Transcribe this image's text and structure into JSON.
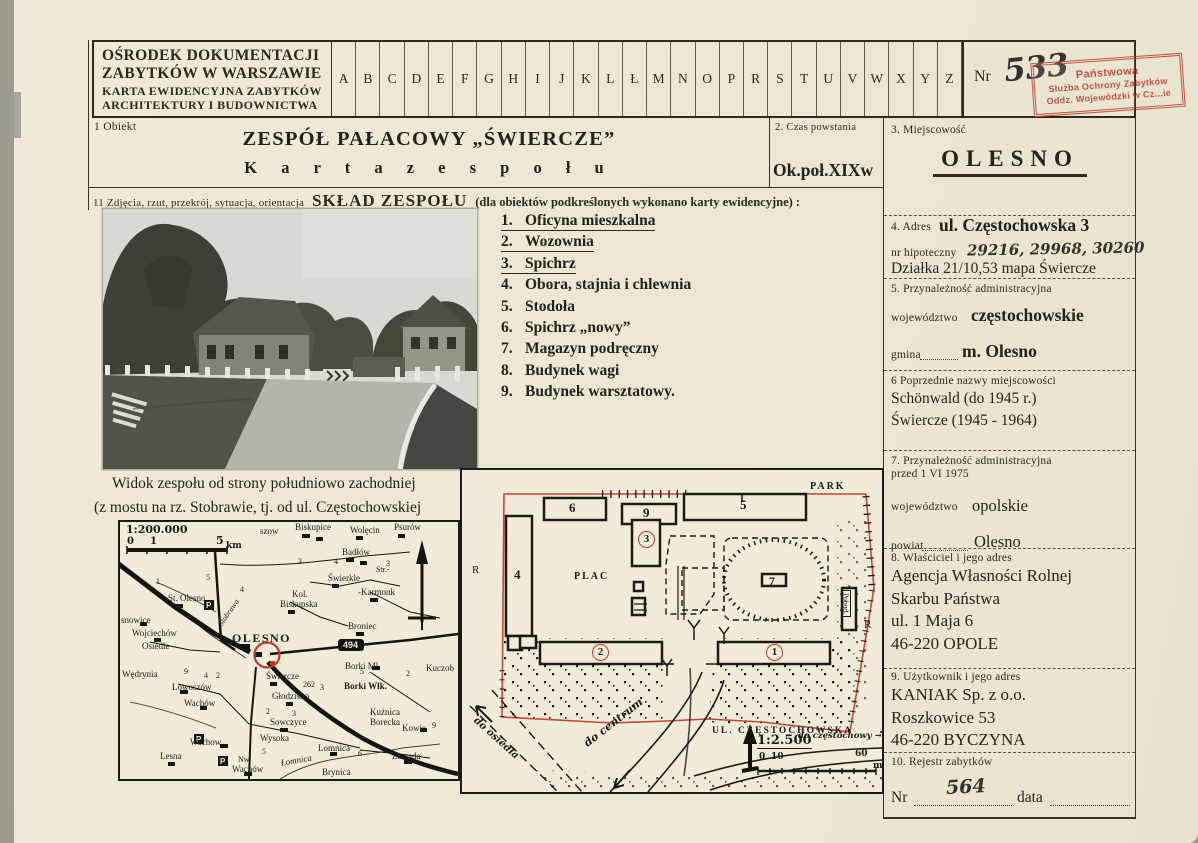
{
  "card": {
    "institution_lines": [
      {
        "t": "OŚRODEK DOKUMENTACJI",
        "fs": 15.5
      },
      {
        "t": "ZABYTKÓW W WARSZAWIE",
        "fs": 15.5
      },
      {
        "t": "KARTA EWIDENCYJNA ZABYTKÓW",
        "fs": 12
      },
      {
        "t": "ARCHITEKTURY I BUDOWNICTWA",
        "fs": 12
      }
    ],
    "index_letters": [
      "A",
      "B",
      "C",
      "D",
      "E",
      "F",
      "G",
      "H",
      "I",
      "J",
      "K",
      "L",
      "Ł",
      "M",
      "N",
      "O",
      "P",
      "R",
      "S",
      "T",
      "U",
      "V",
      "W",
      "X",
      "Y",
      "Z"
    ],
    "nr_label": "Nr",
    "nr_value": "533",
    "stamp_lines": [
      {
        "t": "Państwowa",
        "fs": 11
      },
      {
        "t": "Służba Ochrony Zabytków",
        "fs": 9
      },
      {
        "t": "Oddz. Wojewódzki w Cz...ie",
        "fs": 9
      }
    ],
    "stamp_color": "#c04638"
  },
  "field1": {
    "label": "1  Obiekt",
    "title": "ZESPÓŁ PAŁACOWY „ŚWIERCZE”",
    "subtitle": "K a r t a   z e s p o ł u"
  },
  "field2": {
    "label": "2. Czas powstania",
    "value": "Ok.poł.XIXw"
  },
  "field3": {
    "label": "3.   Miejscowość",
    "value": "OLESNO"
  },
  "field4": {
    "label": "4. Adres",
    "value": "ul. Częstochowska 3",
    "hipoteczny_label": "nr hipoteczny",
    "hipoteczny_value": "29216, 29968, 30260",
    "dzialka": "Działka 21/10,53 mapa Świercze"
  },
  "field5": {
    "label": "5.   Przynależność administracyjna",
    "woj_label": "województwo",
    "woj": "częstochowskie",
    "gmina_label": "gmina",
    "gmina": "m. Olesno"
  },
  "field6": {
    "label": "6  Poprzednie nazwy miejscowości",
    "lines": [
      "Schönwald (do 1945 r.)",
      "Świercze (1945 - 1964)"
    ]
  },
  "field7": {
    "label": "7. Przynależność administracyjna",
    "label2": "przed 1 VI 1975",
    "woj_label": "województwo",
    "woj": "opolskie",
    "powiat_label": "powiat",
    "powiat": "Olesno"
  },
  "field8": {
    "label": "8. Właściciel i jego adres",
    "lines": [
      "Agencja Własności Rolnej",
      "Skarbu Państwa",
      "ul. 1 Maja 6",
      "46-220 OPOLE"
    ]
  },
  "field9": {
    "label": "9. Użytkownik i jego adres",
    "lines": [
      "KANIAK Sp. z o.o.",
      "Roszkowice 53",
      "46-220 BYCZYNA"
    ]
  },
  "field10": {
    "label": "10. Rejestr zabytków",
    "nr_label": "Nr",
    "nr_value": "564",
    "data_label": "data"
  },
  "field11": {
    "label": "11  Zdjęcia, rzut, przekrój, sytuacja, orientacja",
    "heading": "SKŁAD ZESPOŁU",
    "note": "(dla obiektów podkreślonych wykonano karty ewidencyjne) :"
  },
  "composition": [
    {
      "num": "1.",
      "name": "Oficyna mieszkalna",
      "u": true
    },
    {
      "num": "2.",
      "name": "Wozownia",
      "u": true
    },
    {
      "num": "3.",
      "name": "Spichrz",
      "u": true
    },
    {
      "num": "4.",
      "name": "Obora, stajnia i chlewnia"
    },
    {
      "num": "5.",
      "name": "Stodoła"
    },
    {
      "num": "6.",
      "name": "Spichrz „nowy”"
    },
    {
      "num": "7.",
      "name": "Magazyn podręczny"
    },
    {
      "num": "8.",
      "name": "Budynek wagi"
    },
    {
      "num": "9.",
      "name": "Budynek warsztatowy."
    }
  ],
  "photo_caption": [
    {
      "t": "Widok zespołu od strony południowo zachodniej",
      "c": "ind"
    },
    {
      "t": "(z mostu na rz. Stobrawie, tj. od ul. Częstochowskiej"
    }
  ],
  "map": {
    "scale": "1:200.000",
    "road_number": "494",
    "labels": [
      {
        "t": "1:200.000",
        "x": 6,
        "y": 2,
        "c": "h b",
        "fs": 11
      },
      {
        "t": "0",
        "x": 7,
        "y": 15,
        "c": "h",
        "fs": 10
      },
      {
        "t": "1",
        "x": 30,
        "y": 15,
        "c": "h",
        "fs": 10
      },
      {
        "t": "5",
        "x": 96,
        "y": 13,
        "c": "h",
        "fs": 11
      },
      {
        "t": "km",
        "x": 106,
        "y": 20,
        "c": "h",
        "fs": 9
      },
      {
        "t": "szow",
        "x": 140,
        "y": 5
      },
      {
        "t": "Biskupice",
        "x": 175,
        "y": 1
      },
      {
        "t": "Wolęcin",
        "x": 230,
        "y": 4
      },
      {
        "t": "Psurów",
        "x": 274,
        "y": 1
      },
      {
        "t": "Badłów",
        "x": 222,
        "y": 26
      },
      {
        "t": "Świerkle",
        "x": 208,
        "y": 52
      },
      {
        "t": "Str.-",
        "x": 256,
        "y": 44,
        "fs": 8
      },
      {
        "t": "-Karmonk",
        "x": 238,
        "y": 66
      },
      {
        "t": "Kol.",
        "x": 172,
        "y": 68
      },
      {
        "t": "Biskupska",
        "x": 160,
        "y": 78
      },
      {
        "t": "St. Olesno",
        "x": 48,
        "y": 72
      },
      {
        "t": "snowice",
        "x": 1,
        "y": 94
      },
      {
        "t": "Wojciechów",
        "x": 12,
        "y": 107
      },
      {
        "t": "Osiedle",
        "x": 22,
        "y": 120
      },
      {
        "t": "OLESNO",
        "x": 112,
        "y": 110,
        "c": "B"
      },
      {
        "t": "Broniec",
        "x": 228,
        "y": 100
      },
      {
        "t": "Borki Ml.",
        "x": 225,
        "y": 140
      },
      {
        "t": "Kuczob",
        "x": 306,
        "y": 142
      },
      {
        "t": "Wędrynia",
        "x": 2,
        "y": 148
      },
      {
        "t": "Lowoszów",
        "x": 52,
        "y": 161
      },
      {
        "t": "Wachów",
        "x": 64,
        "y": 177
      },
      {
        "t": "Świercze",
        "x": 146,
        "y": 150
      },
      {
        "t": "262",
        "x": 183,
        "y": 159,
        "fs": 8
      },
      {
        "t": "Głodzisko",
        "x": 152,
        "y": 170
      },
      {
        "t": "Borki Wlk.",
        "x": 224,
        "y": 160,
        "c": "b"
      },
      {
        "t": "Kuźnica",
        "x": 250,
        "y": 186
      },
      {
        "t": "Borecka",
        "x": 250,
        "y": 196
      },
      {
        "t": "Kowie",
        "x": 282,
        "y": 202
      },
      {
        "t": "Sowczyce",
        "x": 150,
        "y": 196
      },
      {
        "t": "Wysoka",
        "x": 140,
        "y": 212
      },
      {
        "t": "Lomnica",
        "x": 198,
        "y": 222
      },
      {
        "t": "Łomnica",
        "x": 160,
        "y": 237,
        "c": "i",
        "r": -10
      },
      {
        "t": "Zawada",
        "x": 272,
        "y": 230
      },
      {
        "t": "Lesna",
        "x": 40,
        "y": 230
      },
      {
        "t": "Wachow",
        "x": 70,
        "y": 216
      },
      {
        "t": "Nw.",
        "x": 118,
        "y": 234,
        "fs": 8
      },
      {
        "t": "Wachów",
        "x": 112,
        "y": 243
      },
      {
        "t": "Brynica",
        "x": 202,
        "y": 246
      },
      {
        "t": "Stobrawa",
        "x": 97,
        "y": 101,
        "c": "i",
        "r": -55,
        "fs": 8
      },
      {
        "t": "1",
        "x": 36,
        "y": 56,
        "fs": 8
      },
      {
        "t": "5",
        "x": 86,
        "y": 52,
        "fs": 8
      },
      {
        "t": "3",
        "x": 178,
        "y": 36,
        "fs": 8
      },
      {
        "t": "4",
        "x": 214,
        "y": 36,
        "fs": 8
      },
      {
        "t": "3",
        "x": 266,
        "y": 38,
        "fs": 8
      },
      {
        "t": "4",
        "x": 120,
        "y": 64,
        "fs": 8
      },
      {
        "t": "9",
        "x": 64,
        "y": 146,
        "fs": 8
      },
      {
        "t": "4",
        "x": 84,
        "y": 150,
        "fs": 8
      },
      {
        "t": "2",
        "x": 96,
        "y": 150,
        "fs": 8
      },
      {
        "t": "5",
        "x": 240,
        "y": 146,
        "fs": 8
      },
      {
        "t": "2",
        "x": 286,
        "y": 148,
        "fs": 8
      },
      {
        "t": "3",
        "x": 200,
        "y": 162,
        "fs": 8
      },
      {
        "t": "2",
        "x": 146,
        "y": 186,
        "fs": 8
      },
      {
        "t": "3",
        "x": 172,
        "y": 188,
        "fs": 8
      },
      {
        "t": "5",
        "x": 142,
        "y": 226,
        "fs": 8
      },
      {
        "t": "6",
        "x": 238,
        "y": 228,
        "fs": 8
      },
      {
        "t": "9",
        "x": 312,
        "y": 200,
        "fs": 8
      }
    ]
  },
  "plan": {
    "scale": "1:2.500",
    "labels": [
      {
        "t": "PARK",
        "x": 348,
        "y": 12,
        "c": "sp",
        "fs": 10
      },
      {
        "t": "PLAC",
        "x": 112,
        "y": 102,
        "c": "sp",
        "fs": 10
      },
      {
        "t": "6",
        "x": 107,
        "y": 31,
        "c": "b",
        "fs": 13
      },
      {
        "t": "9",
        "x": 181,
        "y": 36,
        "c": "b",
        "fs": 13
      },
      {
        "t": "5",
        "x": 278,
        "y": 28,
        "c": "b",
        "fs": 13
      },
      {
        "t": "4",
        "x": 52,
        "y": 98,
        "c": "b",
        "fs": 13
      },
      {
        "t": "7",
        "x": 307,
        "y": 105,
        "c": "b",
        "fs": 12
      },
      {
        "t": "3",
        "x": 176,
        "y": 61,
        "c": "rc"
      },
      {
        "t": "2",
        "x": 130,
        "y": 174,
        "c": "rc"
      },
      {
        "t": "1",
        "x": 304,
        "y": 174,
        "c": "rc"
      },
      {
        "t": "R",
        "x": 10,
        "y": 95,
        "fs": 11
      },
      {
        "t": "R",
        "x": 402,
        "y": 150,
        "fs": 11
      },
      {
        "t": "Pobud.",
        "x": 379,
        "y": 120,
        "c": "v",
        "fs": 7.5
      },
      {
        "t": "UL. CZĘSTOCHOWSKA",
        "x": 250,
        "y": 257,
        "c": "sp",
        "fs": 9.5
      },
      {
        "t": "do centrum",
        "x": 120,
        "y": 270,
        "c": "hi",
        "r": -38,
        "fs": 11
      },
      {
        "t": "do osiedla",
        "x": 16,
        "y": 246,
        "c": "hi",
        "r": 42,
        "fs": 10
      },
      {
        "t": "1:2.500",
        "x": 295,
        "y": 264,
        "c": "h un",
        "fs": 13
      },
      {
        "t": "0",
        "x": 297,
        "y": 283,
        "c": "h",
        "fs": 9
      },
      {
        "t": "10",
        "x": 309,
        "y": 283,
        "c": "h",
        "fs": 9
      },
      {
        "t": "60",
        "x": 393,
        "y": 280,
        "c": "h",
        "fs": 9
      },
      {
        "t": "m",
        "x": 411,
        "y": 292,
        "c": "h",
        "fs": 9
      },
      {
        "t": "do częstochowy →",
        "x": 336,
        "y": 262,
        "c": "hi",
        "fs": 8.5
      }
    ]
  }
}
